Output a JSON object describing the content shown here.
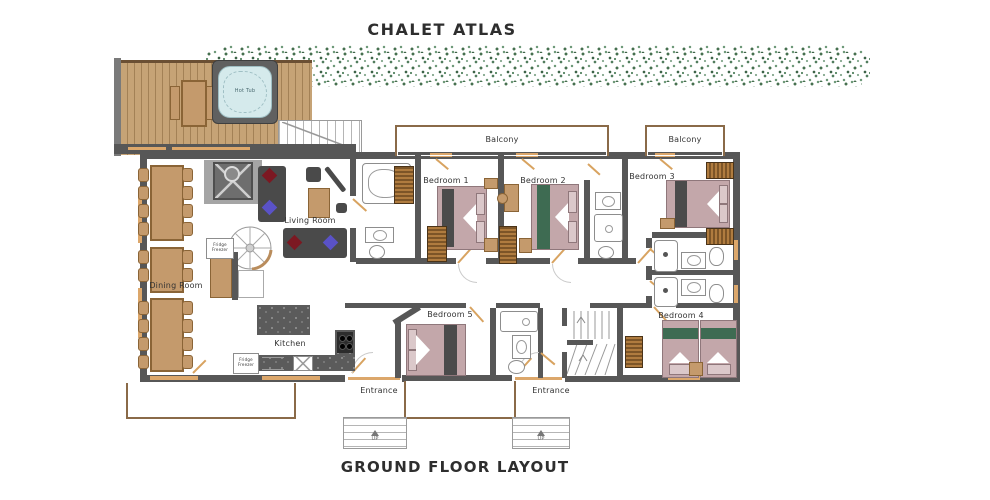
{
  "title": "CHALET ATLAS",
  "subtitle": "GROUND FLOOR LAYOUT",
  "labels": {
    "living_room": "Living Room",
    "dining_room": "Dining Room",
    "kitchen": "Kitchen",
    "bedroom1": "Bedroom 1",
    "bedroom2": "Bedroom 2",
    "bedroom3": "Bedroom 3",
    "bedroom4": "Bedroom 4",
    "bedroom5": "Bedroom 5",
    "balcony_top": "Balcony",
    "balcony_right": "Balcony",
    "entrance_left": "Entrance",
    "entrance_right": "Entrance",
    "hot_tub": "Hot Tub",
    "fridge_freezer": "Fridge Freezer",
    "stairs_up": "UP"
  },
  "colors": {
    "wall": "#575757",
    "wood": "#c49a6c",
    "deck": "#c6a376",
    "bed_mattress": "#c3a7aa",
    "runner_dark": "#4b4b4b",
    "runner_green": "#3e6b52",
    "cushion_red": "#7c1822",
    "cushion_purple": "#5a52c7",
    "hedge_green": "#527d5e",
    "window_trim": "#dca76b",
    "hot_tub_water": "#d5eaec",
    "balcony_trim": "#8a6a48"
  }
}
